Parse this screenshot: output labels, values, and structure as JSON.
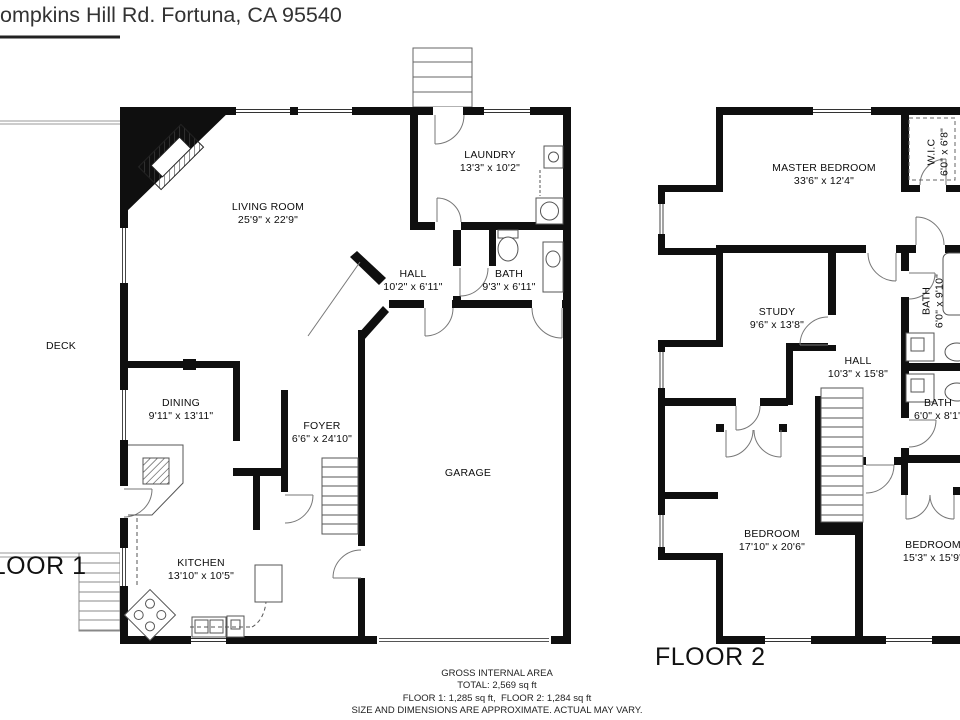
{
  "title": "ompkins Hill Rd. Fortuna, CA 95540",
  "floor1": {
    "label": "FLOOR 1",
    "rooms": {
      "living_room": {
        "name": "LIVING ROOM",
        "dims": "25'9\" x 22'9\""
      },
      "laundry": {
        "name": "LAUNDRY",
        "dims": "13'3\" x 10'2\""
      },
      "hall": {
        "name": "HALL",
        "dims": "10'2\" x 6'11\""
      },
      "bath": {
        "name": "BATH",
        "dims": "9'3\" x 6'11\""
      },
      "deck": {
        "name": "DECK",
        "dims": ""
      },
      "dining": {
        "name": "DINING",
        "dims": "9'11\" x 13'11\""
      },
      "foyer": {
        "name": "FOYER",
        "dims": "6'6\" x 24'10\""
      },
      "garage": {
        "name": "GARAGE",
        "dims": ""
      },
      "kitchen": {
        "name": "KITCHEN",
        "dims": "13'10\" x 10'5\""
      }
    }
  },
  "floor2": {
    "label": "FLOOR 2",
    "rooms": {
      "master_bedroom": {
        "name": "MASTER BEDROOM",
        "dims": "33'6\" x 12'4\""
      },
      "wic": {
        "name": "W.I.C",
        "dims": "6'0\" x 6'8\""
      },
      "study": {
        "name": "STUDY",
        "dims": "9'6\" x 13'8\""
      },
      "hall": {
        "name": "HALL",
        "dims": "10'3\" x 15'8\""
      },
      "bath_upper": {
        "name": "BATH",
        "dims": "6'0\" x 9'10\""
      },
      "bath_lower": {
        "name": "BATH",
        "dims": "6'0\" x 8'1\""
      },
      "bedroom_left": {
        "name": "BEDROOM",
        "dims": "17'10\" x 20'6\""
      },
      "bedroom_right": {
        "name": "BEDROOM",
        "dims": "15'3\" x 15'9\""
      }
    }
  },
  "footer": {
    "line1": "GROSS INTERNAL AREA",
    "line2": "TOTAL: 2,569 sq ft",
    "line3": "FLOOR 1: 1,285 sq ft,  FLOOR 2: 1,284 sq ft",
    "line4": "SIZE AND DIMENSIONS ARE APPROXIMATE. ACTUAL MAY VARY."
  },
  "colors": {
    "wall": "#0f0f0f",
    "thin_line": "#777777",
    "text": "#111111"
  }
}
